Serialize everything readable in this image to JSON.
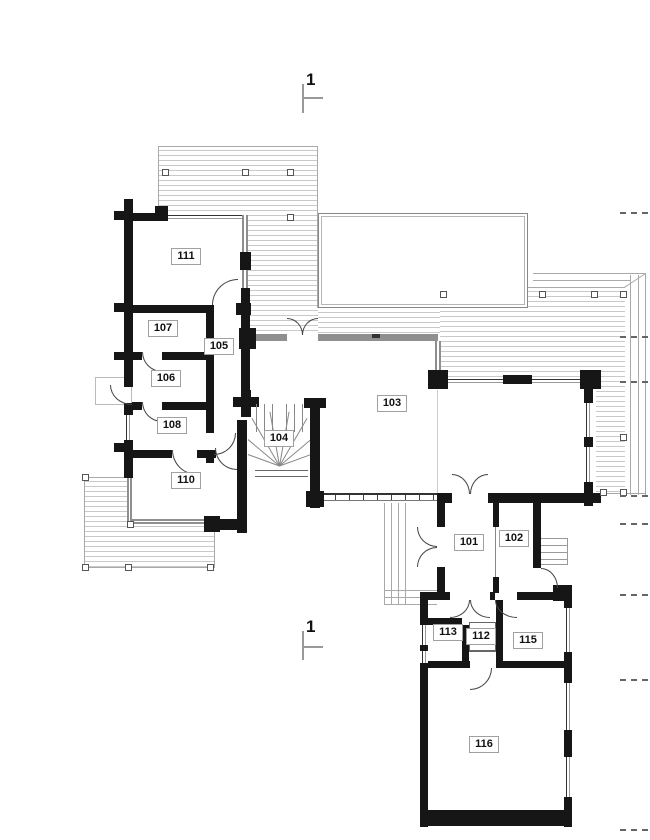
{
  "drawing": {
    "section_markers": {
      "top": "1",
      "bottom": "1"
    },
    "rooms": [
      {
        "number": "101"
      },
      {
        "number": "102"
      },
      {
        "number": "103"
      },
      {
        "number": "104"
      },
      {
        "number": "105"
      },
      {
        "number": "106"
      },
      {
        "number": "107"
      },
      {
        "number": "108"
      },
      {
        "number": "110"
      },
      {
        "number": "111"
      },
      {
        "number": "112"
      },
      {
        "number": "113"
      },
      {
        "number": "115"
      },
      {
        "number": "116"
      }
    ],
    "colors": {
      "wall": "#161616",
      "thin_line": "#a9a9a9",
      "deck_stripe": "#c9c9c9",
      "glazing": "#8f8f8f",
      "dash": "#666666"
    }
  }
}
